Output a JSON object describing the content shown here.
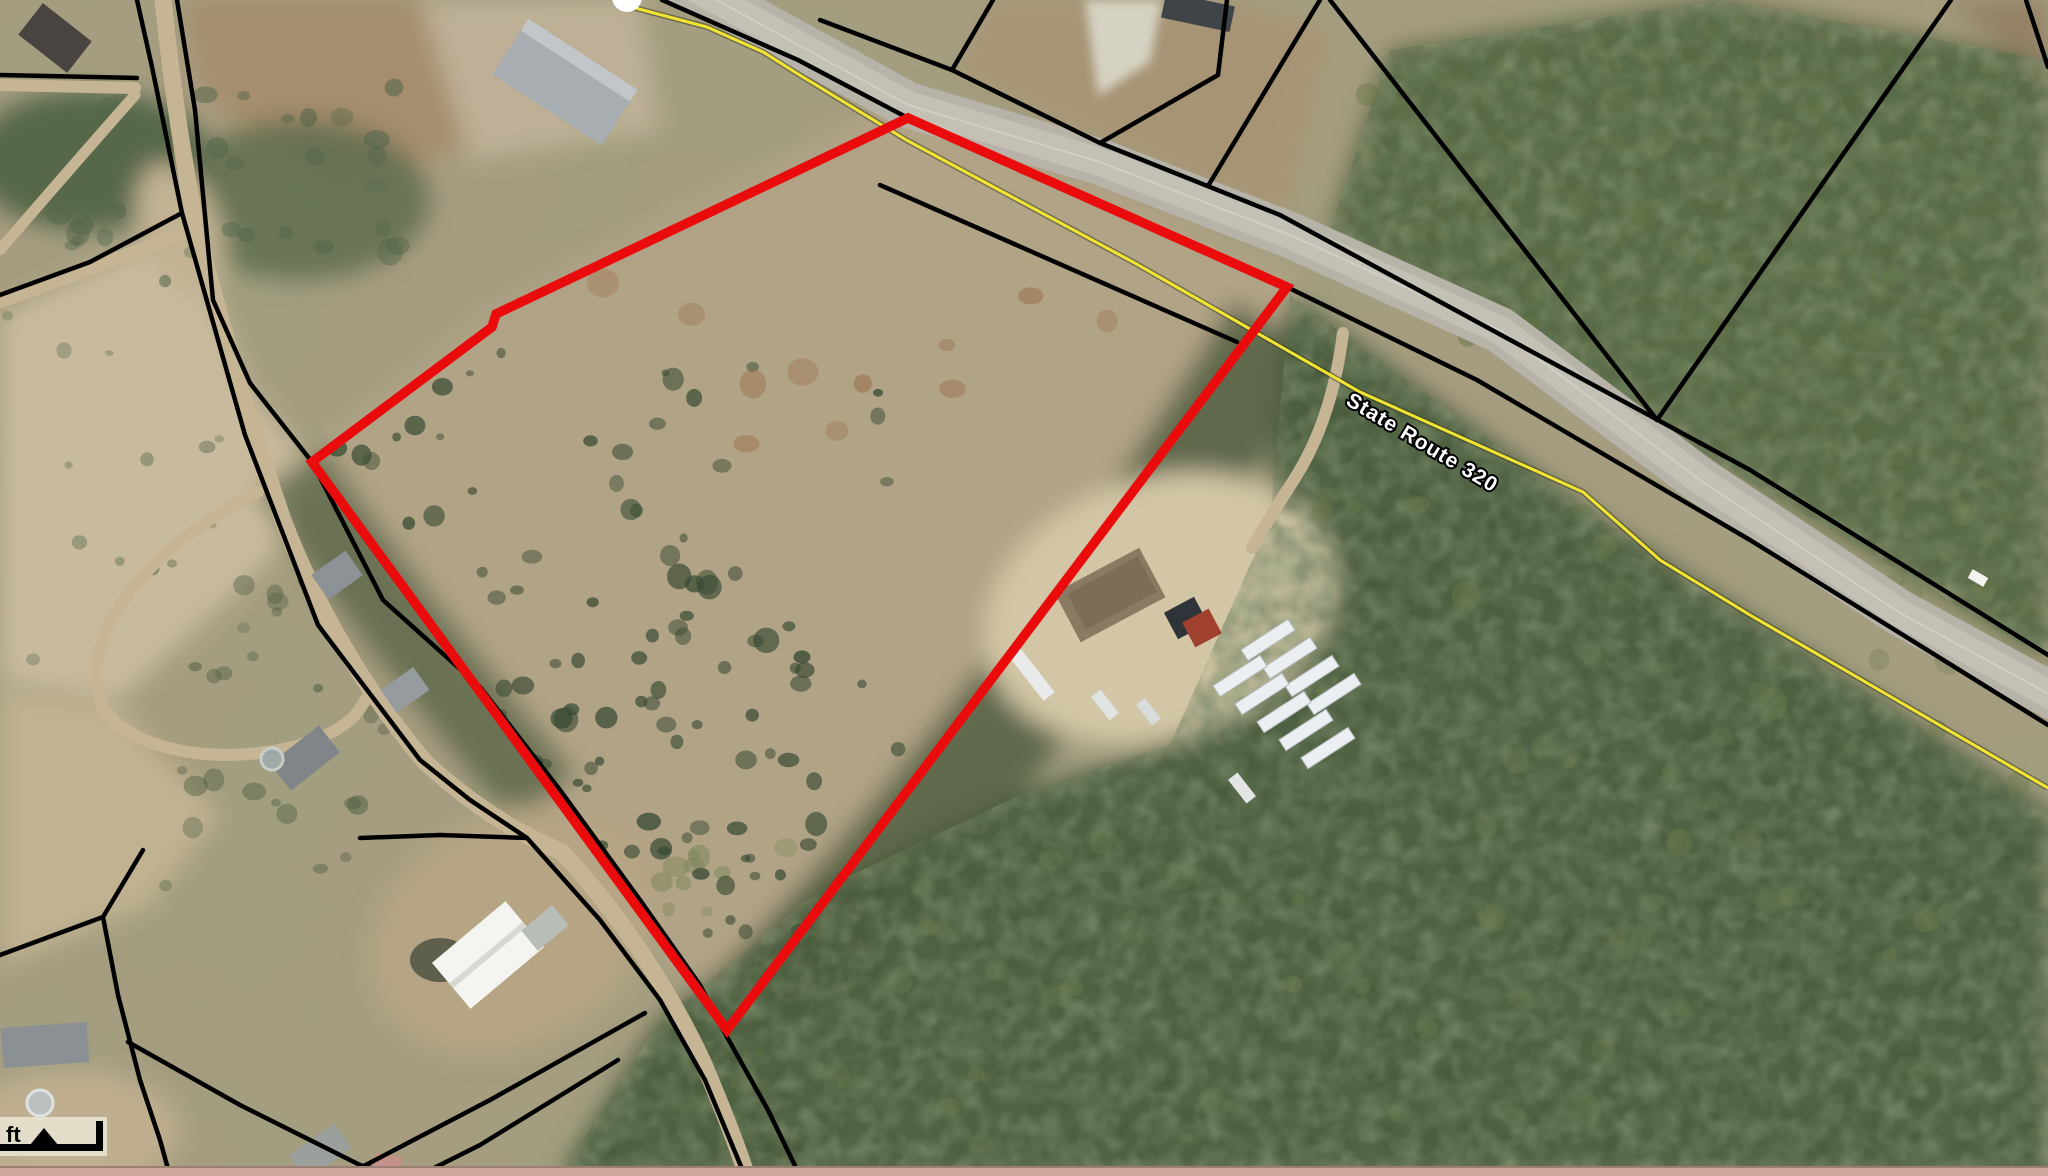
{
  "map": {
    "road_label": "State Route 320",
    "scalebar": {
      "unit_label": "ft"
    },
    "colors": {
      "parcel_highlight": "#ea0c0c",
      "road_centerline": "#f2e531",
      "parcel_boundary": "#000000"
    }
  }
}
